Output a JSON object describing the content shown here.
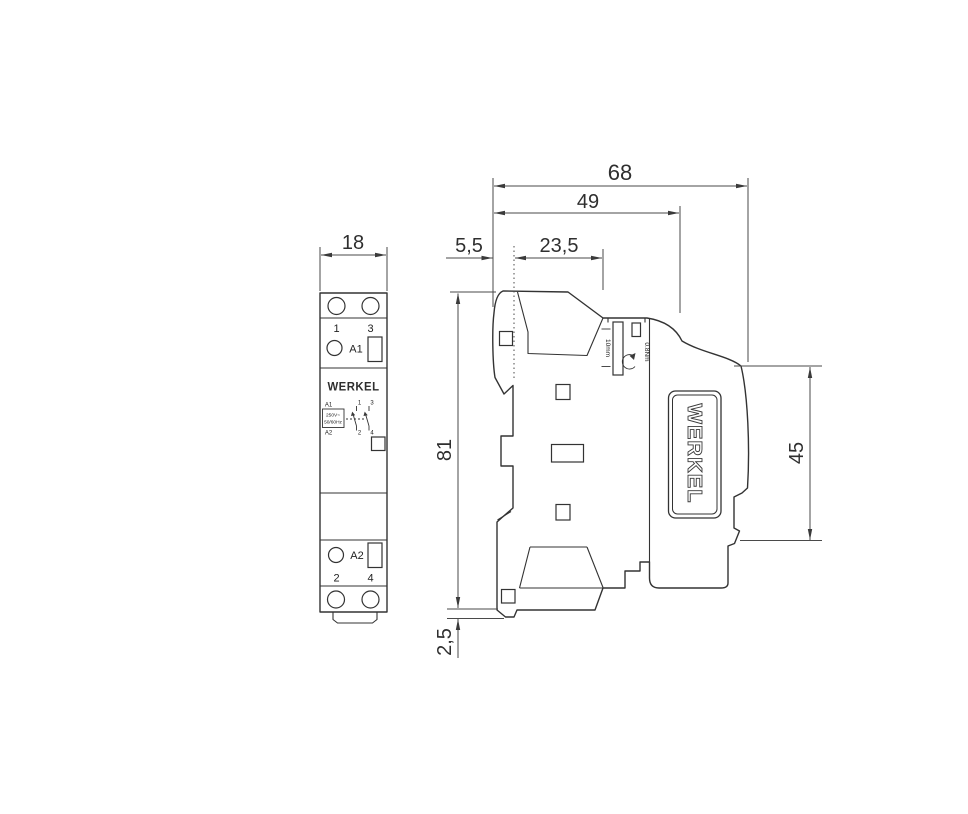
{
  "front_view": {
    "dim_width": "18",
    "top_terminals": {
      "left": "1",
      "right": "3"
    },
    "coil_terminal_top": "A1",
    "brand": "WERKEL",
    "schematic": {
      "a1": "A1",
      "voltage": "250V~",
      "frequency": "50/60Hz",
      "a2": "A2",
      "c1": "1",
      "c3": "3",
      "c2": "2",
      "c4": "4"
    },
    "coil_terminal_bottom": "A2",
    "bottom_terminals": {
      "left": "2",
      "right": "4"
    }
  },
  "side_view": {
    "brand": "WERKEL",
    "strip_gauge": "10mm",
    "torque": "0.8Nm",
    "dim_depth_total": "68",
    "dim_depth_front": "49",
    "dim_offset_front": "5,5",
    "dim_clip_offset": "23,5",
    "dim_height": "81",
    "dim_rail_height": "45",
    "dim_bottom_step": "2,5"
  },
  "colors": {
    "brand_gold": "#8d7150",
    "line": "#333333"
  }
}
